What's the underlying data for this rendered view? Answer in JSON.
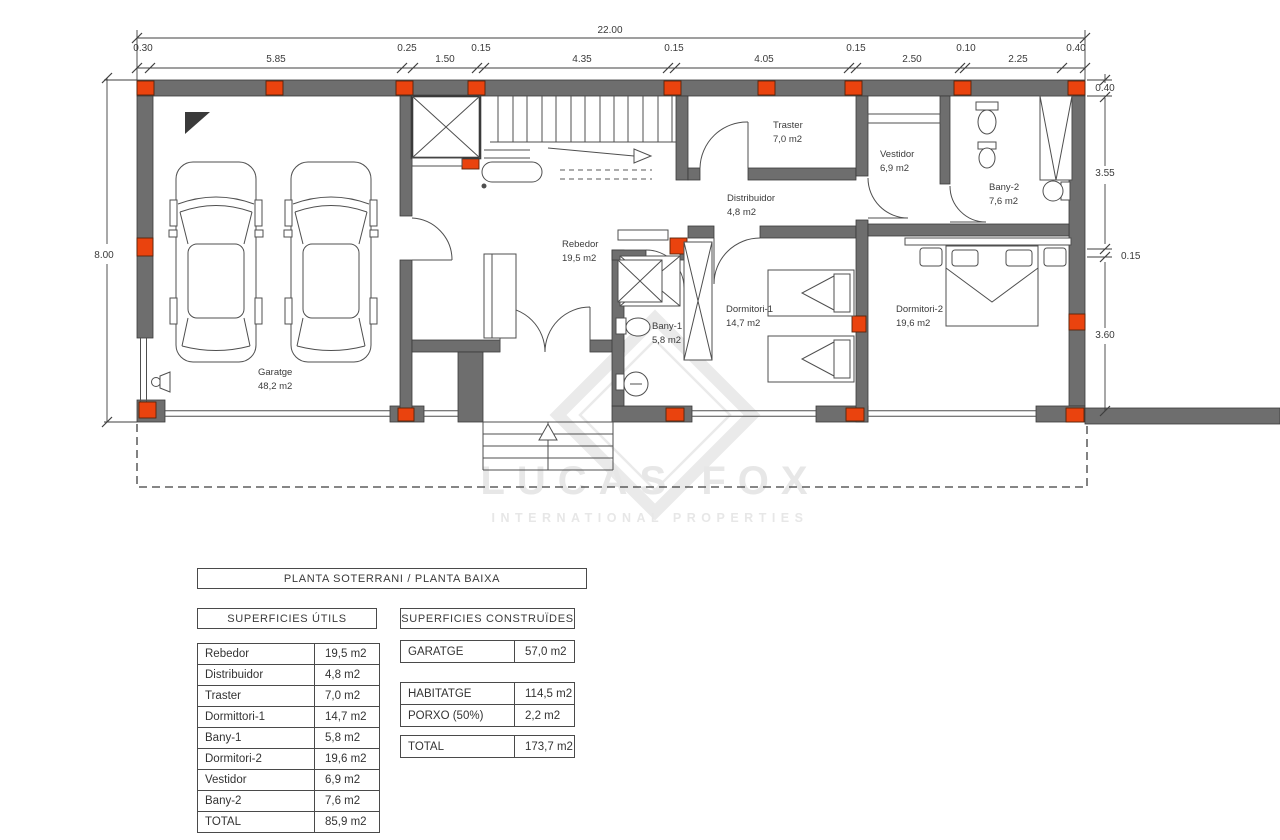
{
  "colors": {
    "wall": "#6e6e6e",
    "pillar": "#ea430e",
    "line": "#3f3f3f",
    "text": "#3b3b3b",
    "watermark": "#e5e5e5"
  },
  "plan": {
    "dims": {
      "total_width": "22.00",
      "top_segments": [
        "0.30",
        "5.85",
        "0.25",
        "1.50",
        "0.15",
        "4.35",
        "0.15",
        "4.05",
        "0.15",
        "2.50",
        "0.10",
        "2.25",
        "0.40"
      ],
      "left_height": "8.00",
      "right_segments": [
        "0.40",
        "3.55",
        "0.15",
        "3.60"
      ]
    },
    "rooms": [
      {
        "name": "Garatge",
        "area": "48,2 m2"
      },
      {
        "name": "Rebedor",
        "area": "19,5 m2"
      },
      {
        "name": "Distribuidor",
        "area": "4,8 m2"
      },
      {
        "name": "Traster",
        "area": "7,0 m2"
      },
      {
        "name": "Vestidor",
        "area": "6,9 m2"
      },
      {
        "name": "Bany-2",
        "area": "7,6 m2"
      },
      {
        "name": "Bany-1",
        "area": "5,8 m2"
      },
      {
        "name": "Dormitori-1",
        "area": "14,7 m2"
      },
      {
        "name": "Dormitori-2",
        "area": "19,6 m2"
      }
    ],
    "watermark": {
      "line1": "LUCAS FOX",
      "line2": "INTERNATIONAL PROPERTIES"
    }
  },
  "tables": {
    "title": "PLANTA SOTERRANI / PLANTA BAIXA",
    "utils": {
      "header": "SUPERFICIES ÚTILS",
      "rows": [
        {
          "label": "Rebedor",
          "value": "19,5 m2"
        },
        {
          "label": "Distribuidor",
          "value": "4,8 m2"
        },
        {
          "label": "Traster",
          "value": "7,0 m2"
        },
        {
          "label": "Dormittori-1",
          "value": "14,7 m2"
        },
        {
          "label": "Bany-1",
          "value": "5,8 m2"
        },
        {
          "label": "Dormitori-2",
          "value": "19,6 m2"
        },
        {
          "label": "Vestidor",
          "value": "6,9 m2"
        },
        {
          "label": "Bany-2",
          "value": "7,6 m2"
        }
      ],
      "total": {
        "label": "TOTAL",
        "value": "85,9 m2"
      }
    },
    "constr": {
      "header": "SUPERFICIES CONSTRUÏDES",
      "garatge": {
        "label": "GARATGE",
        "value": "57,0 m2"
      },
      "rows": [
        {
          "label": "HABITATGE",
          "value": "114,5 m2"
        },
        {
          "label": "PORXO (50%)",
          "value": "2,2 m2"
        }
      ],
      "total": {
        "label": "TOTAL",
        "value": "173,7 m2"
      }
    }
  }
}
